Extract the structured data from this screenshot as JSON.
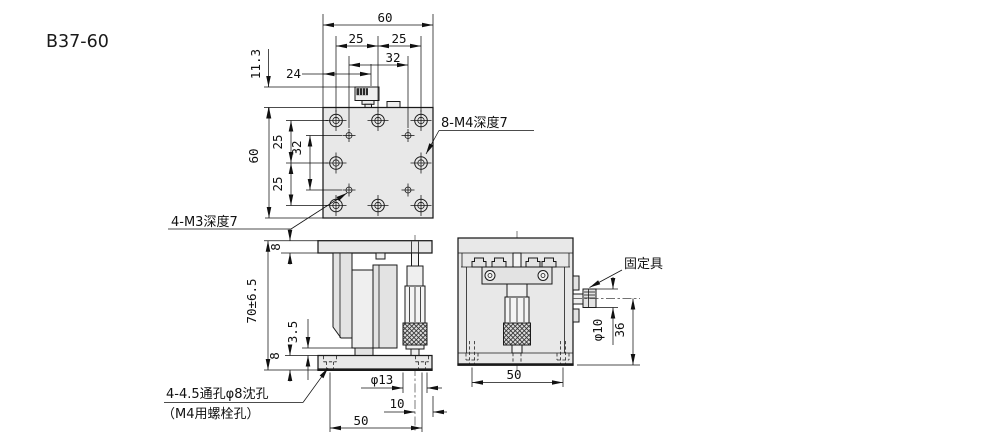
{
  "drawing": {
    "part_number": "B37-60",
    "colors": {
      "line": "#1a1a1a",
      "plate_fill": "#e8e8e8",
      "background": "#ffffff"
    },
    "top_view": {
      "dim_width_60": "60",
      "dim_pitch_left_25": "25",
      "dim_pitch_right_25": "25",
      "dim_span_32": "32",
      "dim_offset_24": "24",
      "dim_height_11_3": "11.3",
      "dim_height_60": "60",
      "dim_pitch_upper_25": "25",
      "dim_span_v_32": "32",
      "dim_pitch_lower_25": "25",
      "label_8_m4": "8-M4深度7",
      "label_4_m3": "4-M3深度7"
    },
    "front_view": {
      "dim_plate_8": "8",
      "dim_height_70": "70±6.5",
      "dim_gap_3_5": "3.5",
      "dim_base_8": "8",
      "dim_dia_13": "φ13",
      "dim_offset_10": "10",
      "dim_pitch_50": "50",
      "label_hole_l1": "4-4.5通孔φ8沈孔",
      "label_hole_l2": "（M4用螺栓孔）"
    },
    "side_view": {
      "label_clamp": "固定具",
      "dim_dia_10": "φ10",
      "dim_height_36": "36",
      "dim_pitch_50": "50"
    }
  }
}
